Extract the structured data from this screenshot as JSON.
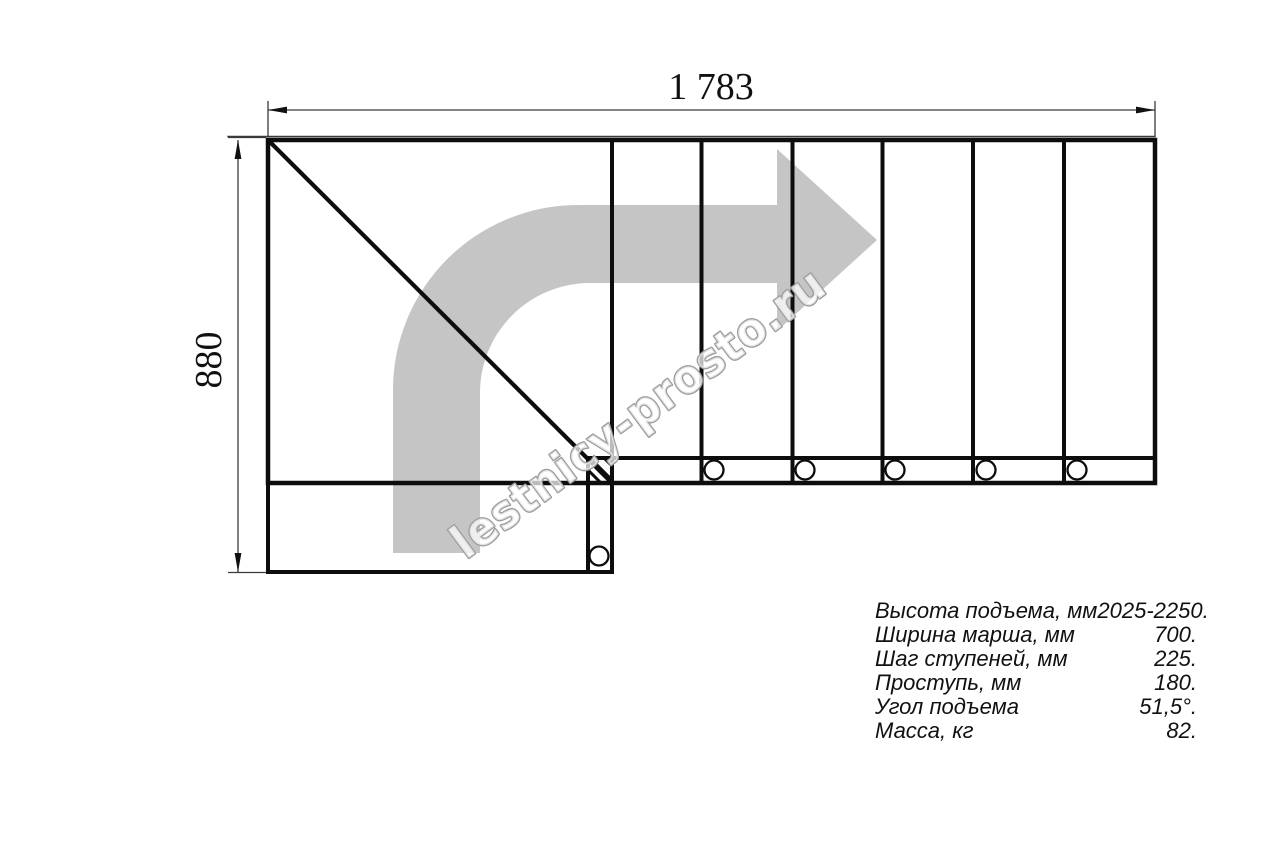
{
  "drawing": {
    "title_hint": "staircase-plan",
    "dimensions": {
      "top_length": "1 783",
      "left_depth": "880"
    },
    "watermark": {
      "text": "lestnicy-prosto.ru"
    },
    "colors": {
      "line": "#0d0d0d",
      "dimension_line": "#3a3a3a",
      "direction_arrow": "#c5c5c5",
      "watermark_outline": "#9c9c9c",
      "background": "#ffffff"
    }
  },
  "specs": {
    "rows": [
      {
        "label": "Высота подъема, мм",
        "value": "2025-2250."
      },
      {
        "label": "Ширина марша, мм",
        "value": "700."
      },
      {
        "label": "Шаг ступеней, мм",
        "value": "225."
      },
      {
        "label": "Проступь, мм",
        "value": "180."
      },
      {
        "label": "Угол подъема",
        "value": "51,5°."
      },
      {
        "label": "Масса, кг",
        "value": "82."
      }
    ]
  }
}
